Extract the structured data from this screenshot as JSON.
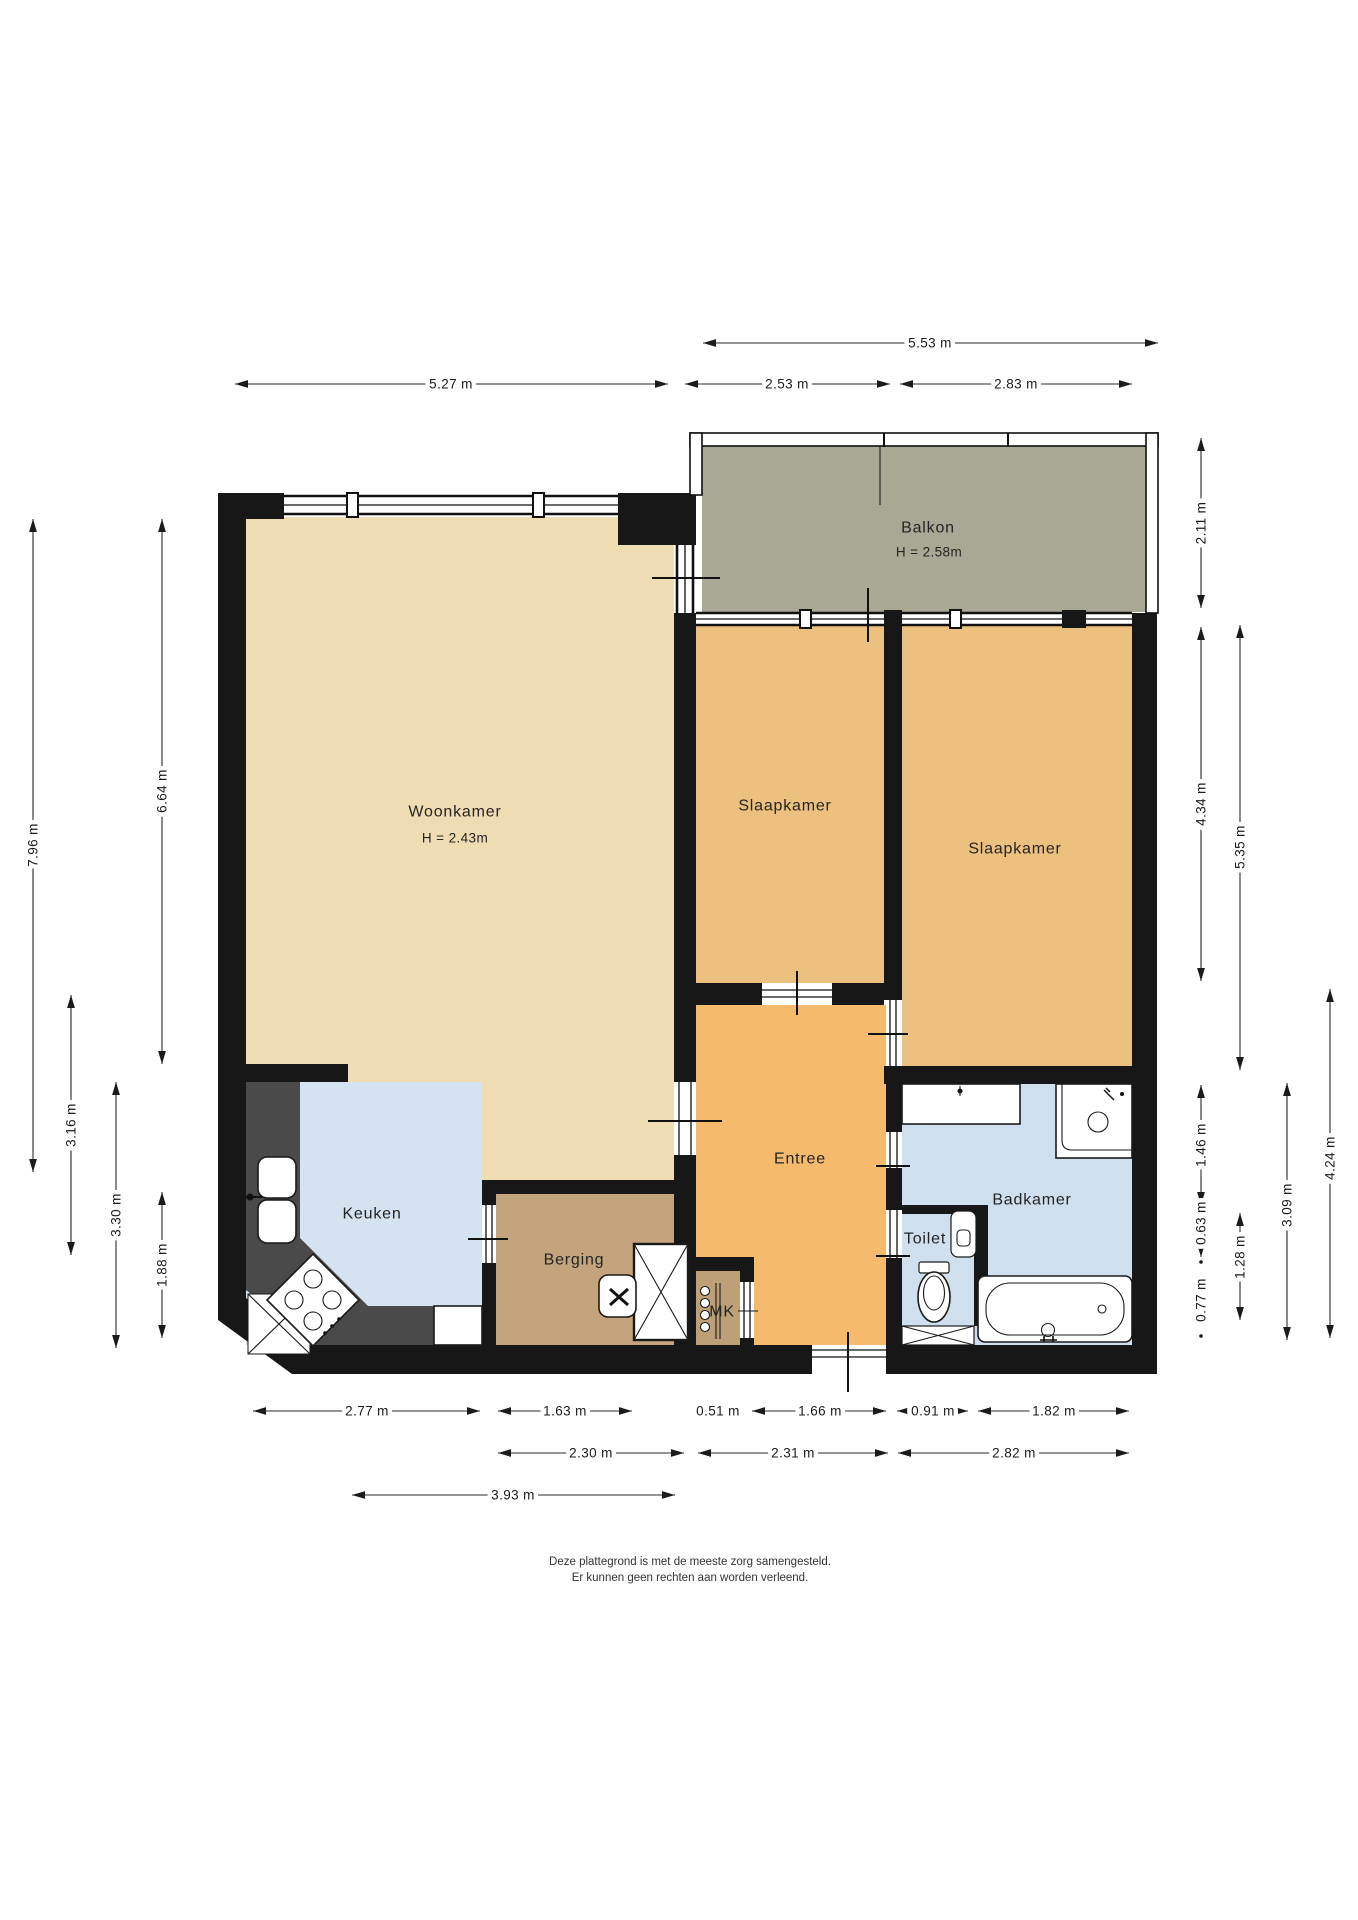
{
  "plan": {
    "type": "floorplan",
    "language": "nl"
  },
  "colors": {
    "wall": "#171717",
    "woonkamer": "#f0dcb2",
    "slaapkamer": "#ecc07e",
    "entree": "#f5ba6b",
    "keuken": "#d5e2f0",
    "badkamer": "#cfdfee",
    "berging": "#c3a47d",
    "mk": "#bda077",
    "balkon": "#a9a894",
    "counter": "#4a4a4a"
  },
  "rooms": {
    "woonkamer": {
      "label": "Woonkamer",
      "height": "H = 2.43m"
    },
    "balkon": {
      "label": "Balkon",
      "height": "H = 2.58m"
    },
    "slaapkamer_links": {
      "label": "Slaapkamer"
    },
    "slaapkamer_rechts": {
      "label": "Slaapkamer"
    },
    "entree": {
      "label": "Entree"
    },
    "keuken": {
      "label": "Keuken"
    },
    "berging": {
      "label": "Berging"
    },
    "mk": {
      "label": "MK"
    },
    "toilet": {
      "label": "Toilet"
    },
    "badkamer": {
      "label": "Badkamer"
    }
  },
  "dims": {
    "top": [
      "5.53 m",
      "5.27 m",
      "2.53 m",
      "2.83 m"
    ],
    "left": [
      "7.96 m",
      "6.64 m",
      "3.16 m",
      "3.30 m",
      "1.88 m"
    ],
    "right": [
      "2.11 m",
      "4.34 m",
      "5.35 m",
      "1.46 m",
      "0.63 m",
      "0.77 m",
      "1.28 m",
      "3.09 m",
      "4.24 m"
    ],
    "bottom": [
      "2.77 m",
      "1.63 m",
      "0.51 m",
      "1.66 m",
      "0.91 m",
      "1.82 m",
      "2.30 m",
      "2.31 m",
      "2.82 m",
      "3.93 m"
    ]
  },
  "footer": {
    "line1": "Deze plattegrond is met de meeste zorg samengesteld.",
    "line2": "Er kunnen geen rechten aan worden verleend."
  }
}
